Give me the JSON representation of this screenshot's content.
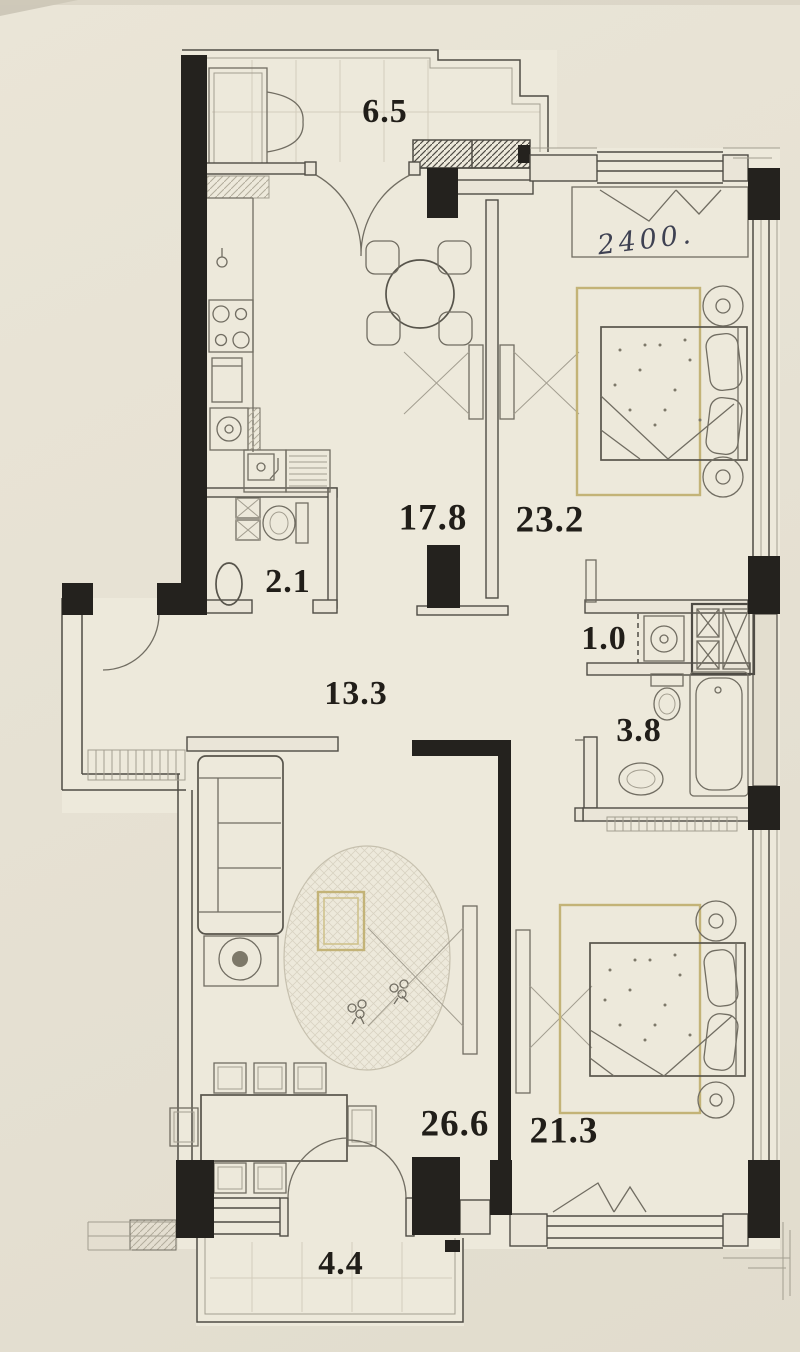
{
  "plan": {
    "title": "apartment-floor-plan",
    "rooms": [
      {
        "key": "loggia-top",
        "label": "6.5"
      },
      {
        "key": "kitchen",
        "label": "17.8"
      },
      {
        "key": "bedroom-1",
        "label": "23.2"
      },
      {
        "key": "wc",
        "label": "2.1"
      },
      {
        "key": "hallway",
        "label": "13.3"
      },
      {
        "key": "laundry-niche",
        "label": "1.0"
      },
      {
        "key": "bathroom",
        "label": "3.8"
      },
      {
        "key": "living-room",
        "label": "26.6"
      },
      {
        "key": "bedroom-2",
        "label": "21.3"
      },
      {
        "key": "balcony-bottom",
        "label": "4.4"
      }
    ],
    "note": {
      "text": "2400."
    },
    "colors": {
      "paper": "#e7e2d4",
      "wall_dark": "#24221e",
      "furniture_accent": "#c3b377",
      "label_ink": "#211e19",
      "note_ink": "#3e4152"
    }
  }
}
